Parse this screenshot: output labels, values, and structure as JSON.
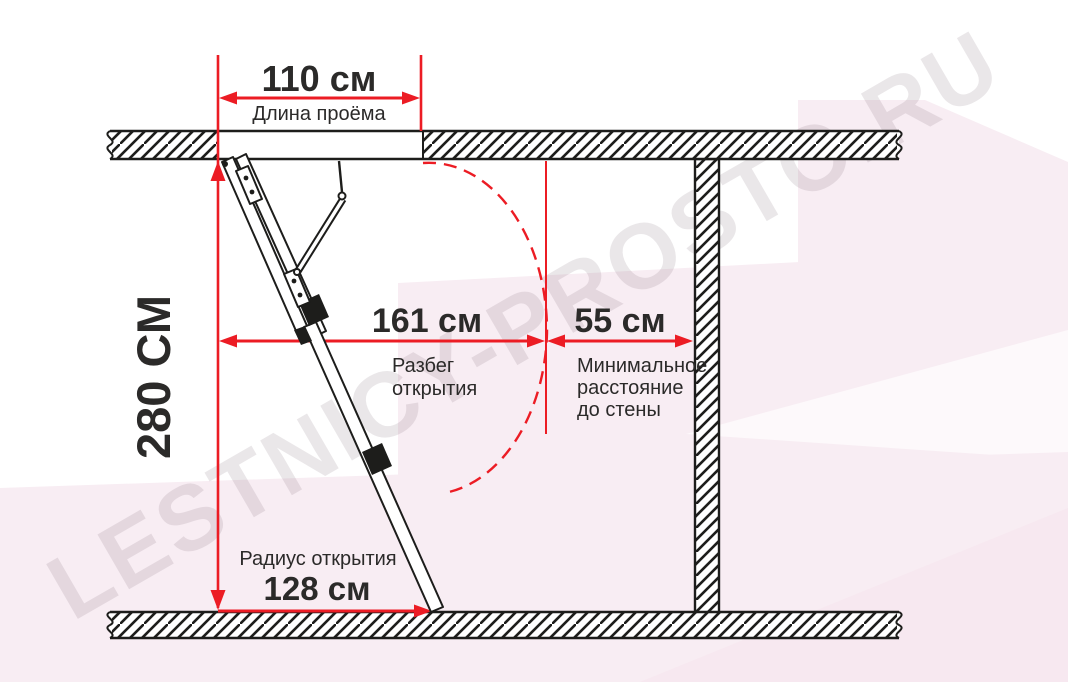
{
  "watermark_text": "LESTNICY-PROSTO.RU",
  "colors": {
    "red": "#ec1c24",
    "ink": "#1d1d1b",
    "text": "#2b2a29",
    "pink": "#f8edf3",
    "pink_soft": "#fdf9fb",
    "watermark": "#6e5a68"
  },
  "dims": {
    "opening": {
      "value": "110 см",
      "caption": "Длина проёма"
    },
    "height": {
      "value": "280 СМ"
    },
    "swing": {
      "value": "161 см",
      "caption_line1": "Разбег",
      "caption_line2": "открытия"
    },
    "wall_clearance": {
      "value": "55 см",
      "caption_line1": "Минимальное",
      "caption_line2": "расстояние",
      "caption_line3": "до стены"
    },
    "radius": {
      "value": "128 см",
      "caption": "Радиус открытия"
    }
  }
}
